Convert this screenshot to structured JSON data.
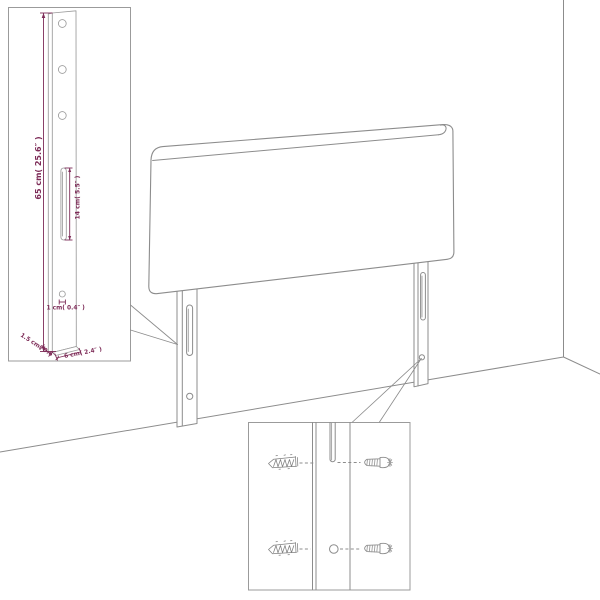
{
  "diagram": {
    "kind": "headboard-assembly-drawing",
    "colors": {
      "background": "#ffffff",
      "drawing_line": "#8c8c8c",
      "dimension_text": "#7d2b57"
    },
    "leg_detail_inset": {
      "labels": {
        "height": "65 cm( 25.6″ )",
        "slot_length": "14 cm( 5.5″ )",
        "hole_diameter": "1 cm( 0.4″ )",
        "thickness": "1.5 cm( 0.6″ )",
        "width": "6 cm( 2.4″ )"
      },
      "hole_count": 3,
      "slot_count": 1
    },
    "screw_detail_inset": {
      "screw_count": 2,
      "anchor_sketch_count": 2,
      "hole_count": 1,
      "slot_count": 1
    },
    "headboard": {
      "leg_count": 2,
      "slots_per_leg": 1,
      "holes_per_leg": 1
    }
  }
}
